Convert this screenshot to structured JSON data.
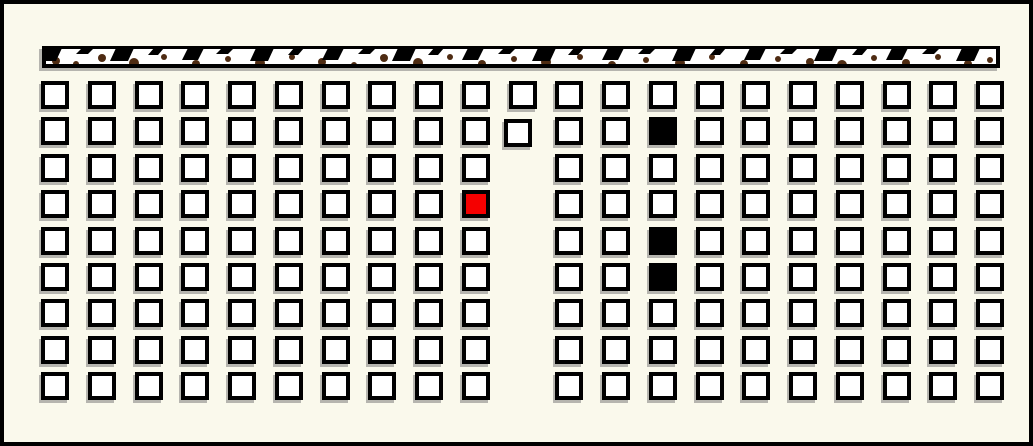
{
  "app": {
    "background": "#faf9ec",
    "frame_border_color": "#000000",
    "shadow_color": "rgba(125,125,125,0.55)"
  },
  "board": {
    "x": 38,
    "y": 42,
    "width": 958,
    "height": 22,
    "border_color": "#000000",
    "fill_color": "#ffffff",
    "dot_color": "#4e2b12",
    "tooth_color": "#000000",
    "border_top": 3,
    "border_bottom": 4,
    "border_side": 4,
    "tooth_lean": -6,
    "teeth_xwh": [
      [
        4,
        16,
        13
      ],
      [
        40,
        12,
        6
      ],
      [
        74,
        18,
        13
      ],
      [
        112,
        10,
        7
      ],
      [
        146,
        16,
        12
      ],
      [
        180,
        12,
        6
      ],
      [
        214,
        18,
        13
      ],
      [
        252,
        10,
        7
      ],
      [
        286,
        16,
        12
      ],
      [
        322,
        12,
        6
      ],
      [
        356,
        18,
        13
      ],
      [
        392,
        10,
        7
      ],
      [
        426,
        16,
        12
      ],
      [
        462,
        12,
        6
      ],
      [
        496,
        18,
        13
      ],
      [
        532,
        10,
        7
      ],
      [
        566,
        16,
        12
      ],
      [
        602,
        12,
        6
      ],
      [
        636,
        18,
        13
      ],
      [
        674,
        10,
        7
      ],
      [
        708,
        16,
        12
      ],
      [
        744,
        12,
        6
      ],
      [
        778,
        18,
        13
      ],
      [
        816,
        10,
        7
      ],
      [
        850,
        16,
        12
      ],
      [
        886,
        12,
        6
      ],
      [
        920,
        18,
        13
      ]
    ],
    "dots_xyr": [
      [
        14,
        15,
        4
      ],
      [
        34,
        18,
        3
      ],
      [
        60,
        12,
        4
      ],
      [
        92,
        17,
        5
      ],
      [
        122,
        11,
        3
      ],
      [
        154,
        18,
        4
      ],
      [
        186,
        13,
        3
      ],
      [
        218,
        17,
        5
      ],
      [
        250,
        11,
        3
      ],
      [
        280,
        16,
        4
      ],
      [
        312,
        19,
        3
      ],
      [
        342,
        12,
        4
      ],
      [
        376,
        17,
        5
      ],
      [
        408,
        11,
        3
      ],
      [
        440,
        18,
        4
      ],
      [
        472,
        13,
        3
      ],
      [
        504,
        16,
        5
      ],
      [
        538,
        11,
        3
      ],
      [
        570,
        19,
        4
      ],
      [
        604,
        14,
        3
      ],
      [
        638,
        17,
        5
      ],
      [
        670,
        11,
        3
      ],
      [
        702,
        18,
        4
      ],
      [
        736,
        13,
        3
      ],
      [
        768,
        16,
        4
      ],
      [
        800,
        19,
        5
      ],
      [
        832,
        12,
        3
      ],
      [
        864,
        17,
        4
      ],
      [
        896,
        11,
        3
      ],
      [
        926,
        18,
        4
      ],
      [
        948,
        14,
        3
      ]
    ]
  },
  "grid": {
    "columns": 21,
    "rows": 9,
    "origin_x": 37,
    "origin_y": 77,
    "col_pitch": 46.75,
    "row_pitch": 36.4,
    "cell_size": 28,
    "cell_border_color": "#000000",
    "cell_fill_color": "#ffffff",
    "red_color": "#f50000",
    "black_color": "#000000",
    "missing_cells": [
      {
        "row": 2,
        "col": 10
      },
      {
        "row": 3,
        "col": 10
      },
      {
        "row": 4,
        "col": 10
      },
      {
        "row": 5,
        "col": 10
      },
      {
        "row": 6,
        "col": 10
      },
      {
        "row": 7,
        "col": 10
      },
      {
        "row": 8,
        "col": 10
      }
    ],
    "special_cells": [
      {
        "row": 1,
        "col": 10,
        "type": "offset",
        "dx": -5,
        "dy": 2
      },
      {
        "row": 1,
        "col": 13,
        "type": "black"
      },
      {
        "row": 3,
        "col": 9,
        "type": "red"
      },
      {
        "row": 4,
        "col": 13,
        "type": "black"
      },
      {
        "row": 5,
        "col": 13,
        "type": "black"
      }
    ]
  }
}
